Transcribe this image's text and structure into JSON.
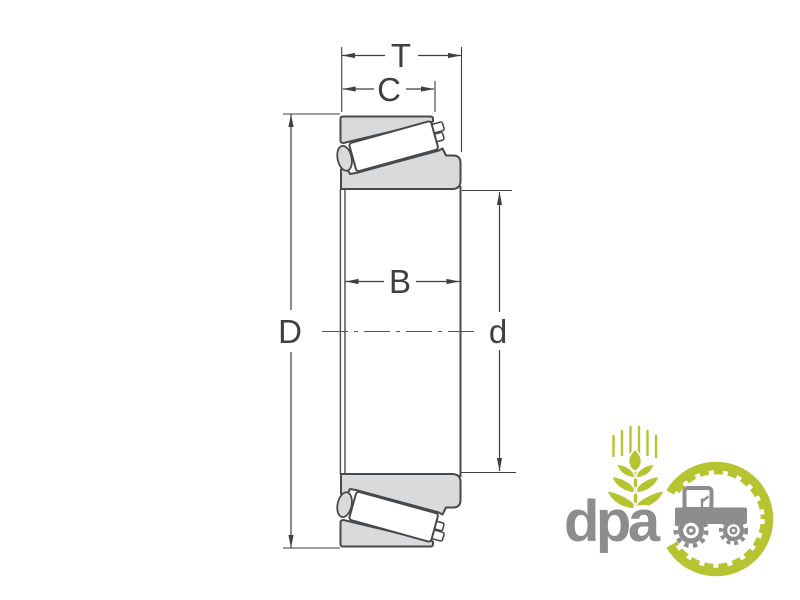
{
  "diagram": {
    "title": "Tapered roller bearing cross-section dimensional drawing",
    "labels": {
      "total_width": "T",
      "cup_width": "C",
      "inner_ring_width": "B",
      "outer_diameter": "D",
      "bore_diameter": "d"
    }
  },
  "logo": {
    "brand": "dpa"
  },
  "colors": {
    "background": "#ffffff",
    "drawing_line": "#3d3f41",
    "bearing_fill": "#d9dadb",
    "bearing_stroke": "#47494b",
    "logo_green": "#b5c430",
    "logo_gray": "#8d8d8d"
  }
}
